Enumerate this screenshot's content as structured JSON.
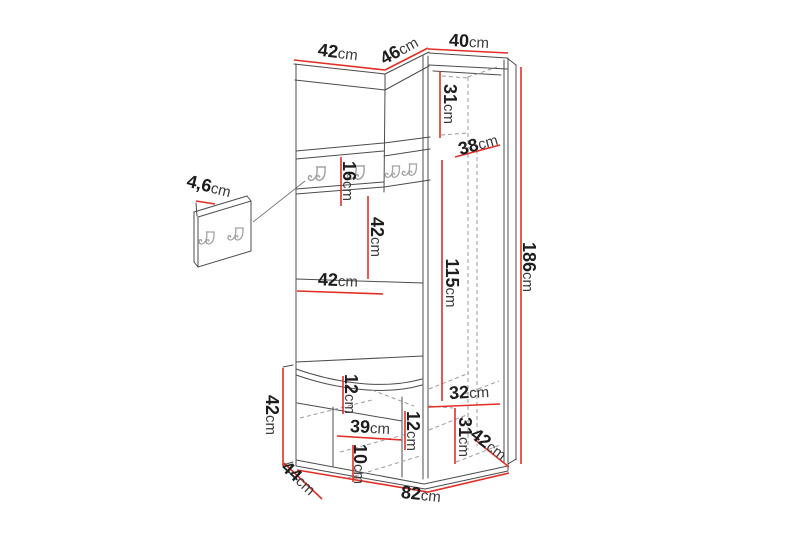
{
  "unit": "cm",
  "colors": {
    "dimension_line": "#e12f27",
    "outline": "#4c4c4c",
    "hidden_line": "#9b9b9b",
    "hook": "#a5a5a5",
    "label_text": "#1d1d1d",
    "background": "#ffffff"
  },
  "dimensions": [
    {
      "id": "left-section-width",
      "value": "42"
    },
    {
      "id": "corner-section-width",
      "value": "46"
    },
    {
      "id": "right-section-width",
      "value": "40"
    },
    {
      "id": "top-compartment-height",
      "value": "31"
    },
    {
      "id": "corner-inner-depth",
      "value": "38"
    },
    {
      "id": "hook-panel-height",
      "value": "16"
    },
    {
      "id": "niche-height",
      "value": "42"
    },
    {
      "id": "niche-width",
      "value": "42"
    },
    {
      "id": "cabinet-interior-height",
      "value": "115"
    },
    {
      "id": "total-height",
      "value": "186"
    },
    {
      "id": "bench-height",
      "value": "42"
    },
    {
      "id": "seat-thickness",
      "value": "12"
    },
    {
      "id": "bench-inner-width",
      "value": "39"
    },
    {
      "id": "plinth-height",
      "value": "10"
    },
    {
      "id": "bench-inner-height",
      "value": "12"
    },
    {
      "id": "lower-compartment-width",
      "value": "32"
    },
    {
      "id": "lower-compartment-height",
      "value": "31"
    },
    {
      "id": "right-section-depth",
      "value": "42"
    },
    {
      "id": "bench-depth",
      "value": "44"
    },
    {
      "id": "total-width",
      "value": "82"
    },
    {
      "id": "hook-panel-thickness",
      "value": "4,6"
    }
  ]
}
